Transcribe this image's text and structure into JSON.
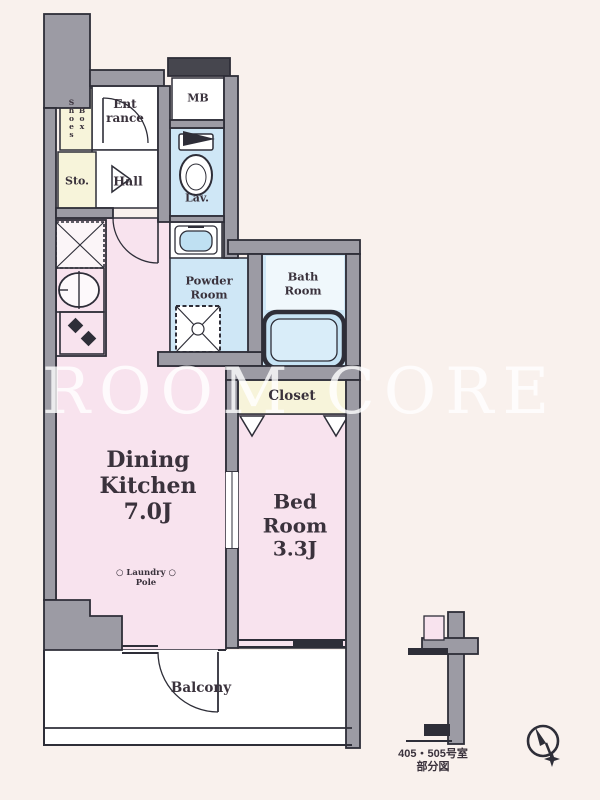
{
  "watermark_text": "ROOM CORE",
  "rooms": {
    "shoes_box": "Shoes\nBox",
    "entrance": "Ent\nrance",
    "meter_box": "MB",
    "storage": "Sto.",
    "hall": "Hall",
    "lavatory": "Lav.",
    "powder_room": "Powder\nRoom",
    "bath_room": "Bath\nRoom",
    "closet": "Closet",
    "dining_kitchen": "Dining\nKitchen\n7.0J",
    "bed_room": "Bed\nRoom\n3.3J",
    "balcony": "Balcony"
  },
  "annotations": {
    "laundry_pole": "○ Laundry ○\nPole",
    "caption": "405・505号室\n部分図"
  },
  "colors": {
    "background": "#f9f1ed",
    "wall_gray": "#9c9ba4",
    "outline": "#2e2e38",
    "room_pink": "#f8e3ee",
    "room_blue": "#cfe7f6",
    "room_yellow": "#f7f4da",
    "text": "#3a323c",
    "watermark": "#ffffff"
  }
}
